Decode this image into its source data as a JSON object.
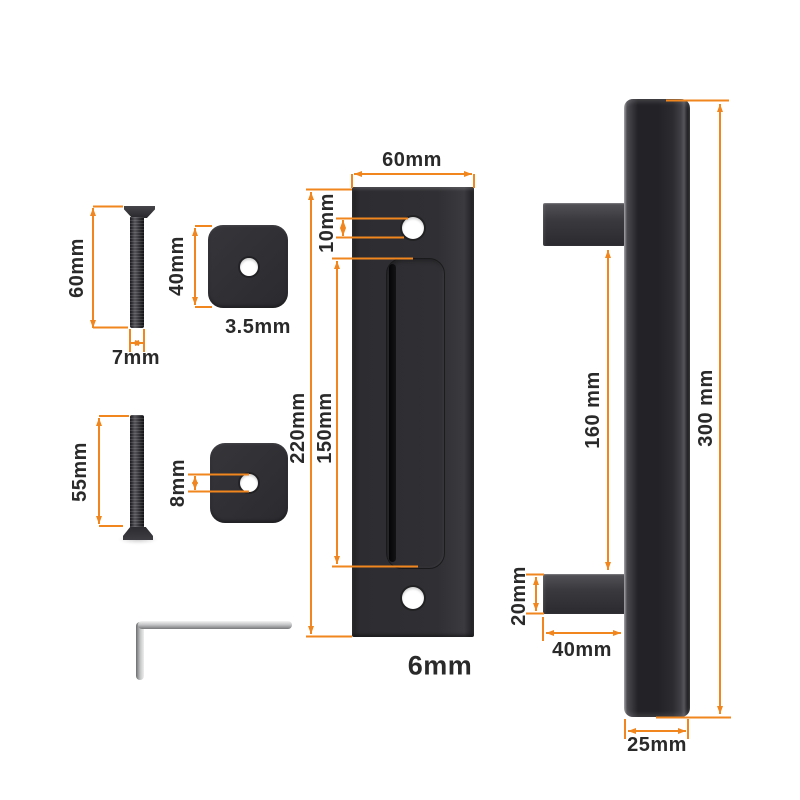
{
  "accent_color": "#F0861D",
  "text_color": "#2a2a2a",
  "metal_color": "#2d2d31",
  "labels": {
    "screw_long_length": "60mm",
    "screw_long_diameter": "7mm",
    "spacer_top_size": "40mm",
    "spacer_top_thickness": "3.5mm",
    "screw_short_length": "55mm",
    "spacer_bottom_hole": "8mm",
    "pull_width": "60mm",
    "pull_hole_diameter": "10mm",
    "pull_height": "220mm",
    "pull_recess_length": "150mm",
    "pull_thickness": "6mm",
    "handle_hole_spacing": "160 mm",
    "handle_length": "300 mm",
    "handle_post_height": "20mm",
    "handle_post_length": "40mm",
    "handle_bar_width": "25mm"
  }
}
